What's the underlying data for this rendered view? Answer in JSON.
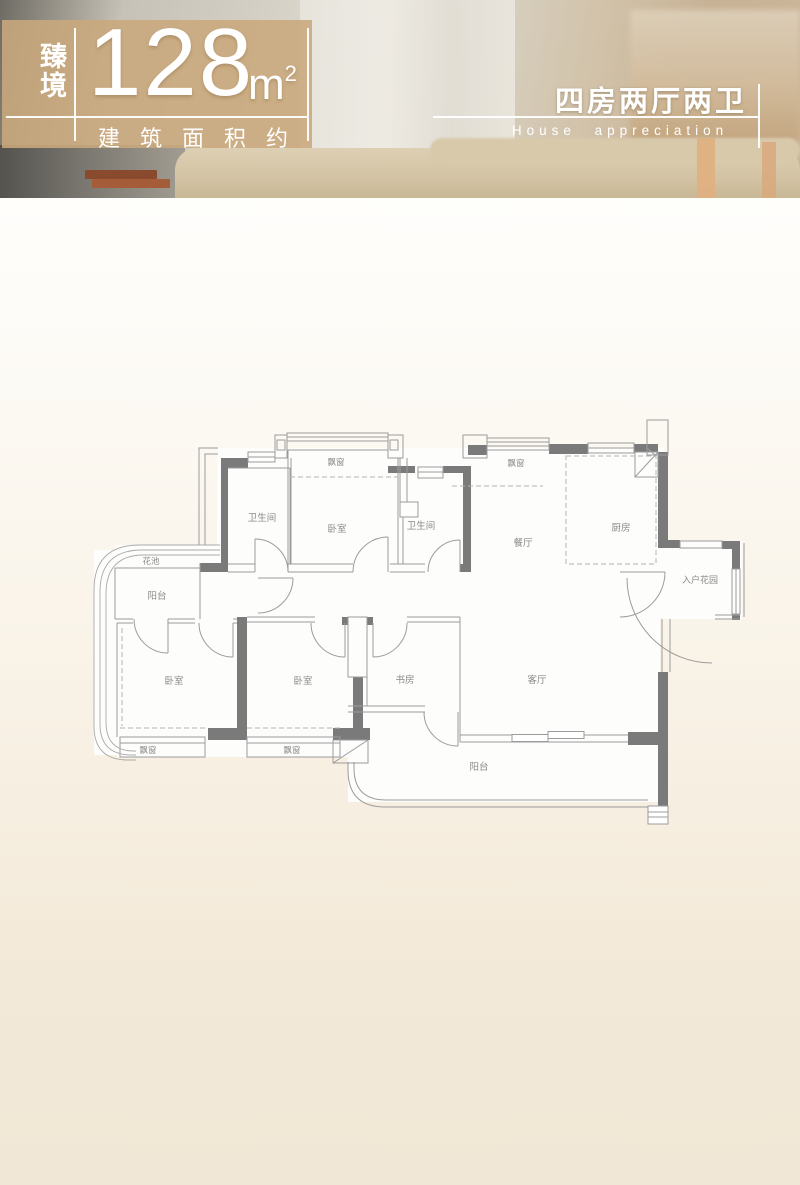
{
  "header": {
    "badge_vertical": "臻境",
    "area_value": "128",
    "area_unit": "m",
    "area_unit_sup": "2",
    "area_caption": "建筑面积约",
    "layout_title": "四房两厅两卫",
    "layout_subtitle": "House appreciation",
    "overlay_color": "#c9a87c"
  },
  "plan": {
    "wall_color": "#7a7a7a",
    "line_color": "#9c9c9c",
    "labels": [
      {
        "text": "卫生间"
      },
      {
        "text": "卧室"
      },
      {
        "text": "卫生间"
      },
      {
        "text": "餐厅"
      },
      {
        "text": "厨房"
      },
      {
        "text": "入户花园"
      },
      {
        "text": "花池"
      },
      {
        "text": "阳台"
      },
      {
        "text": "卧室"
      },
      {
        "text": "卧室"
      },
      {
        "text": "书房"
      },
      {
        "text": "客厅"
      },
      {
        "text": "阳台"
      },
      {
        "text": "飘窗"
      },
      {
        "text": "飘窗"
      },
      {
        "text": "飘窗"
      },
      {
        "text": "飘窗"
      }
    ]
  }
}
